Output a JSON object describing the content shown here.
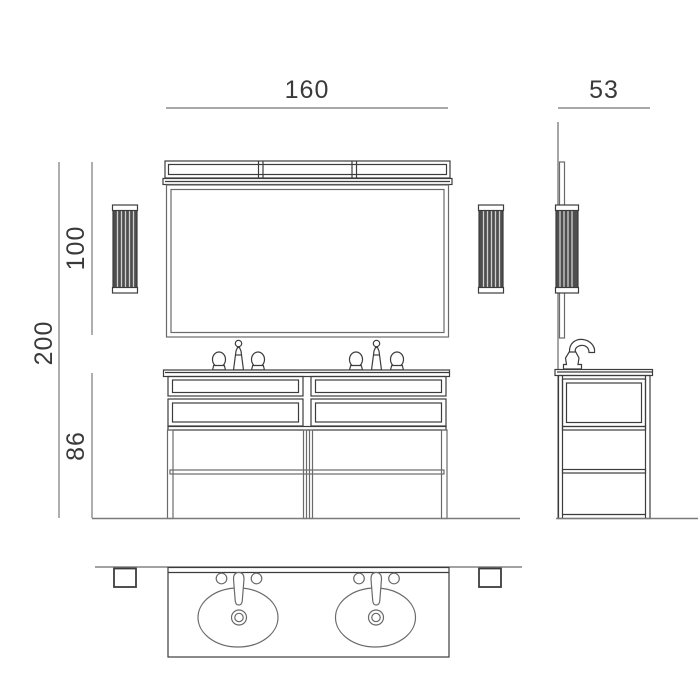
{
  "drawing": {
    "type": "technical-dimension-drawing",
    "views": {
      "front": "front-elevation",
      "side": "side-elevation",
      "plan": "plan-view"
    }
  },
  "dimensions": {
    "front_width": "160",
    "side_depth": "53",
    "mirror_section_height": "100",
    "overall_height": "200",
    "cabinet_height": "86"
  },
  "colors": {
    "background": "#ffffff",
    "line": "#6a6a6a",
    "line_dark": "#3c3c3c",
    "dim_line": "#8b8b8b",
    "floor_line": "#7a7a7a",
    "text": "#3a3a3a",
    "sconce_fill": "#4e4e4e",
    "sconce_stripe": "#cfcfcf",
    "white": "#ffffff"
  }
}
